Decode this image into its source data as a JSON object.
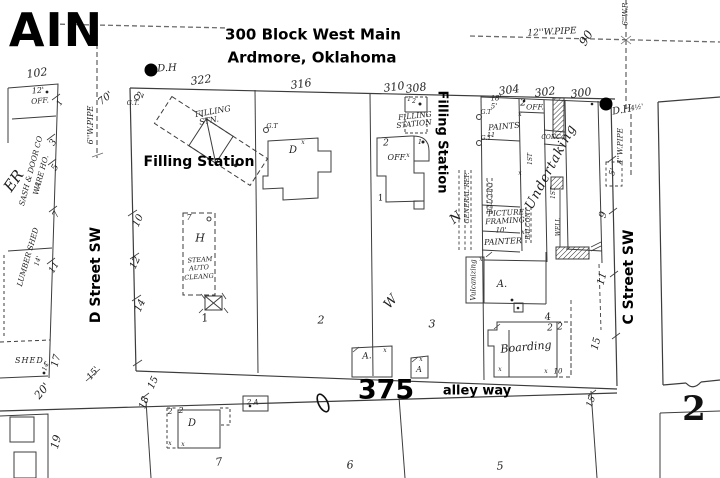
{
  "map_title": {
    "line1": "300 Block West Main",
    "line2": "Ardmore, Oklahoma"
  },
  "streets": {
    "main_partial": "AIN",
    "d_street": "D Street SW",
    "c_street": "C Street SW",
    "alley": "alley way"
  },
  "block": {
    "number": "375",
    "adjacent_sheet": "2"
  },
  "annotations": {
    "filling_station": "Filling Station"
  },
  "addresses": {
    "a102": "102",
    "a300": "300",
    "a302": "302",
    "a304": "304",
    "a308": "308",
    "a310": "310",
    "a316": "316",
    "a322": "322"
  },
  "buildings": {
    "filling": "FILLING",
    "stn": "STN.",
    "station": "STATION",
    "paints": "PAINTS",
    "office": "OFF.",
    "conc": "CONC",
    "undertaking": "Undertaking",
    "first_floor": "1ST",
    "balcony": "BALCONY",
    "well": "WELL",
    "picture": "PICTURE",
    "framing": "FRAMING",
    "painter": "PAINTER",
    "general_repair": "GENERAL REP.",
    "vulcanizing": "Vulcanizing",
    "boarding": "Boarding",
    "steam": "STEAM",
    "auto": "AUTO",
    "cleaning": "CLEANG",
    "sash_door": "SASH & DOOR CO",
    "warehouse": "WARE HO.",
    "lumber_shed": "LUMBER SHED",
    "shed": "SHED.",
    "lumber_fragment": "ER",
    "dwelling": "D",
    "store_a": "A.",
    "store_a_plain": "A",
    "h_flag": "H",
    "w_flag": "W",
    "n_flag": "N"
  },
  "marks": {
    "x": "x",
    "gas_tank": "G.T.",
    "gas_tank_short": "G.T",
    "double_hydrant": "D.H"
  },
  "numbers": {
    "n1": "1",
    "n2": "2",
    "n3": "3",
    "n4": "4",
    "n5": "5",
    "n6": "6",
    "n7": "7",
    "n9": "9",
    "n10": "10",
    "n11": "11",
    "n12": "12",
    "n14": "14",
    "n15": "15",
    "n17": "17",
    "n18": "18",
    "n19": "19"
  },
  "distances": {
    "d4half": "4½'",
    "d5": "5'",
    "d10": "10'",
    "d12": "12'",
    "d14": "14'",
    "d15": "15'",
    "d18": "18'",
    "d20": "20'",
    "d70": "70'"
  },
  "pipes": {
    "w6": "6''W.PIPE",
    "w6_short": "6''W.P.",
    "w12": "12''W.PIPE",
    "w4": "4''W.PIPE",
    "n90": "90"
  }
}
